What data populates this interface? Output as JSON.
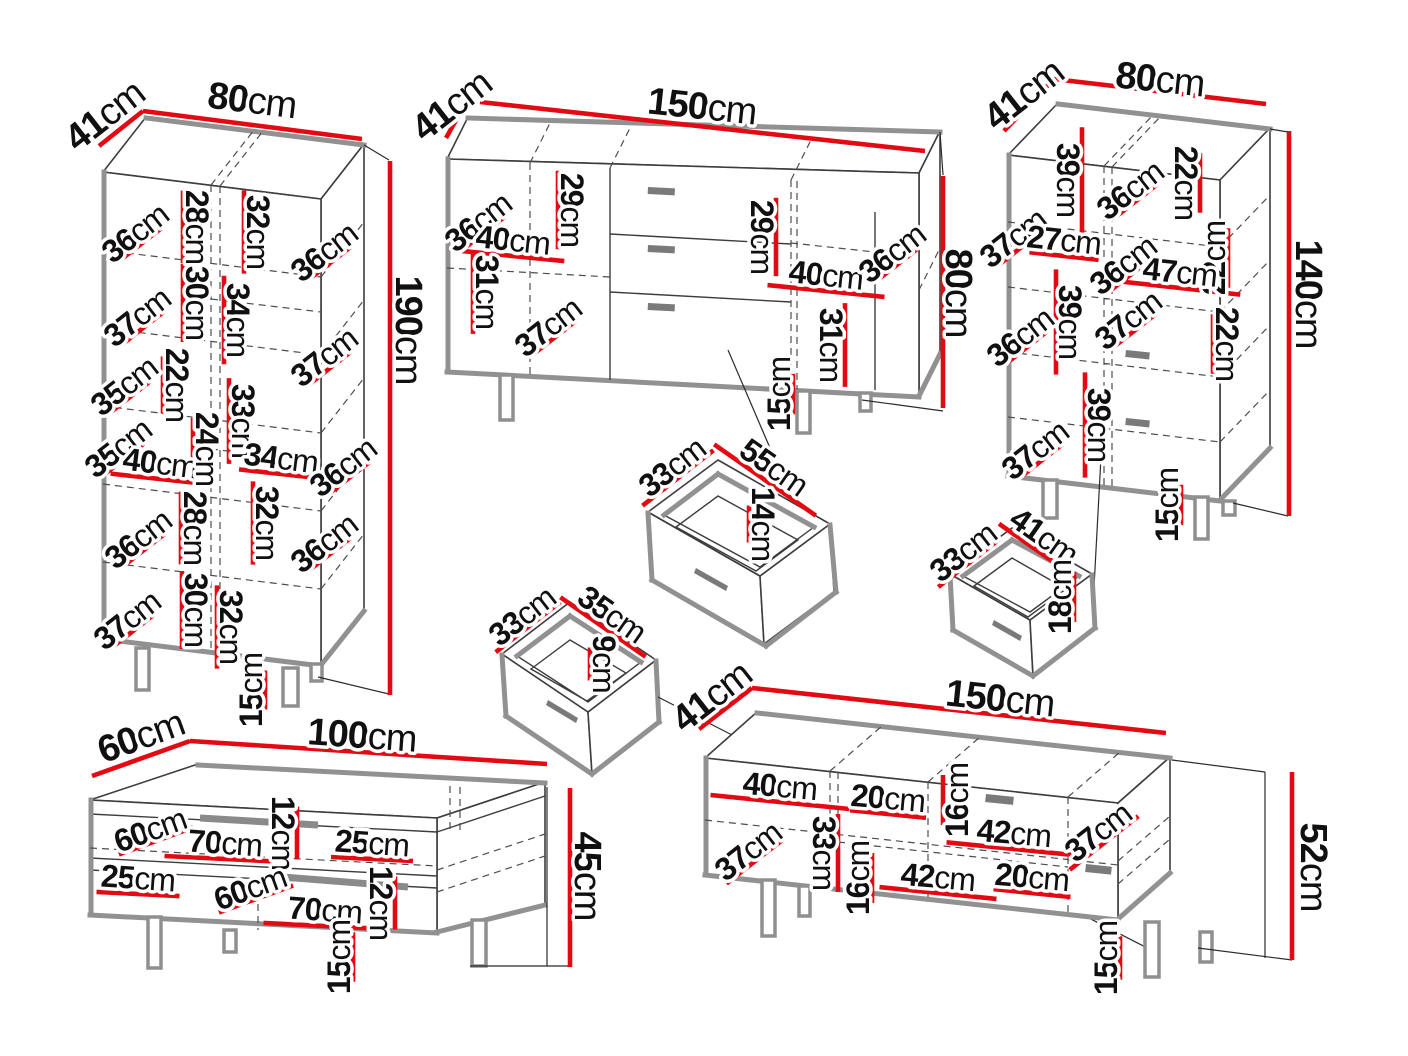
{
  "diagram_title": "furniture-dimensions-diagram",
  "unit": "cm",
  "colors": {
    "dimension_red": "#e30b13",
    "outline": "#3d3d3d",
    "shadow_gray": "#919191",
    "text": "#101010"
  },
  "pieces": [
    {
      "id": "tall-cabinet",
      "kind": "cabinet",
      "overall": {
        "width": "80cm",
        "depth": "41cm",
        "height": "190cm",
        "leg_height": "15cm"
      },
      "scale": 2.6,
      "dfac": 0.55,
      "hslope": 0.11,
      "labels": [
        {
          "t": "41cm",
          "x": 105,
          "y": 116,
          "r": -38,
          "s": "big",
          "line": "none"
        },
        {
          "t": "80cm",
          "x": 252,
          "y": 101,
          "r": 7,
          "s": "big",
          "line": "none"
        },
        {
          "t": "190cm",
          "x": 408,
          "y": 330,
          "r": 90,
          "s": "big",
          "line": "none"
        },
        {
          "t": "36cm",
          "x": 135,
          "y": 233,
          "r": -38
        },
        {
          "t": "28cm",
          "x": 197,
          "y": 227,
          "r": 90
        },
        {
          "t": "32cm",
          "x": 258,
          "y": 232,
          "r": 90
        },
        {
          "t": "36cm",
          "x": 324,
          "y": 252,
          "r": -38
        },
        {
          "t": "37cm",
          "x": 137,
          "y": 317,
          "r": -38
        },
        {
          "t": "30cm",
          "x": 197,
          "y": 303,
          "r": 90
        },
        {
          "t": "34cm",
          "x": 238,
          "y": 320,
          "r": 90
        },
        {
          "t": "37cm",
          "x": 324,
          "y": 357,
          "r": -38
        },
        {
          "t": "35cm",
          "x": 124,
          "y": 386,
          "r": -38
        },
        {
          "t": "22cm",
          "x": 177,
          "y": 385,
          "r": 90
        },
        {
          "t": "33cm",
          "x": 243,
          "y": 421,
          "r": 90
        },
        {
          "t": "35cm",
          "x": 118,
          "y": 448,
          "r": -38
        },
        {
          "t": "40cm",
          "x": 160,
          "y": 463,
          "r": 7
        },
        {
          "t": "24cm",
          "x": 207,
          "y": 449,
          "r": 90
        },
        {
          "t": "34cm",
          "x": 281,
          "y": 458,
          "r": 7
        },
        {
          "t": "36cm",
          "x": 343,
          "y": 467,
          "r": -38
        },
        {
          "t": "36cm",
          "x": 138,
          "y": 539,
          "r": -38
        },
        {
          "t": "28cm",
          "x": 195,
          "y": 528,
          "r": 90
        },
        {
          "t": "32cm",
          "x": 267,
          "y": 523,
          "r": 90
        },
        {
          "t": "36cm",
          "x": 324,
          "y": 543,
          "r": -38
        },
        {
          "t": "37cm",
          "x": 127,
          "y": 620,
          "r": -38
        },
        {
          "t": "30cm",
          "x": 196,
          "y": 610,
          "r": 90
        },
        {
          "t": "32cm",
          "x": 231,
          "y": 627,
          "r": 90
        },
        {
          "t": "15cm",
          "x": 251,
          "y": 690,
          "r": -90
        }
      ]
    },
    {
      "id": "sideboard",
      "kind": "sideboard",
      "overall": {
        "width": "150cm",
        "depth": "41cm",
        "height": "80cm",
        "leg_height": "15cm"
      },
      "scale": 2.7,
      "dfac": 0.55,
      "hslope": 0.1,
      "labels": [
        {
          "t": "41cm",
          "x": 452,
          "y": 106,
          "r": -38,
          "s": "big",
          "line": "none"
        },
        {
          "t": "150cm",
          "x": 702,
          "y": 107,
          "r": 6,
          "s": "big",
          "line": "none"
        },
        {
          "t": "80cm",
          "x": 958,
          "y": 293,
          "r": 90,
          "s": "big",
          "line": "none"
        },
        {
          "t": "36cm",
          "x": 478,
          "y": 222,
          "r": -38
        },
        {
          "t": "29cm",
          "x": 572,
          "y": 210,
          "r": 90
        },
        {
          "t": "40cm",
          "x": 513,
          "y": 240,
          "r": 6
        },
        {
          "t": "31cm",
          "x": 487,
          "y": 292,
          "r": 90
        },
        {
          "t": "37cm",
          "x": 548,
          "y": 327,
          "r": -38
        },
        {
          "t": "29cm",
          "x": 762,
          "y": 237,
          "r": 90,
          "side": 1
        },
        {
          "t": "40cm",
          "x": 826,
          "y": 275,
          "r": 6,
          "len": 117
        },
        {
          "t": "36cm",
          "x": 892,
          "y": 253,
          "r": -38
        },
        {
          "t": "31cm",
          "x": 831,
          "y": 345,
          "r": 90,
          "side": 1
        },
        {
          "t": "15cm",
          "x": 779,
          "y": 394,
          "r": -90
        }
      ]
    },
    {
      "id": "high-cabinet",
      "kind": "cabinet",
      "overall": {
        "width": "80cm",
        "depth": "41cm",
        "height": "140cm",
        "leg_height": "15cm"
      },
      "scale": 2.7,
      "dfac": 0.55,
      "hslope": 0.11,
      "labels": [
        {
          "t": "41cm",
          "x": 1024,
          "y": 95,
          "r": -38,
          "s": "big",
          "line": "none"
        },
        {
          "t": "80cm",
          "x": 1160,
          "y": 80,
          "r": 6,
          "s": "big",
          "line": "none"
        },
        {
          "t": "140cm",
          "x": 1308,
          "y": 294,
          "r": 90,
          "s": "big",
          "line": "none"
        },
        {
          "t": "39cm",
          "x": 1068,
          "y": 180,
          "r": 90,
          "side": 1
        },
        {
          "t": "36cm",
          "x": 1130,
          "y": 190,
          "r": -38
        },
        {
          "t": "22cm",
          "x": 1186,
          "y": 183,
          "r": 90,
          "side": 1
        },
        {
          "t": "37cm",
          "x": 1013,
          "y": 238,
          "r": -38
        },
        {
          "t": "27cm",
          "x": 1064,
          "y": 240,
          "r": 6
        },
        {
          "t": "22cm",
          "x": 1214,
          "y": 258,
          "r": -90
        },
        {
          "t": "36cm",
          "x": 1123,
          "y": 265,
          "r": -38
        },
        {
          "t": "47cm",
          "x": 1180,
          "y": 272,
          "r": 6
        },
        {
          "t": "36cm",
          "x": 1020,
          "y": 337,
          "r": -38
        },
        {
          "t": "39cm",
          "x": 1070,
          "y": 322,
          "r": 90
        },
        {
          "t": "37cm",
          "x": 1128,
          "y": 320,
          "r": -38
        },
        {
          "t": "22cm",
          "x": 1227,
          "y": 344,
          "r": 90
        },
        {
          "t": "39cm",
          "x": 1099,
          "y": 425,
          "r": 90
        },
        {
          "t": "37cm",
          "x": 1035,
          "y": 450,
          "r": -38
        },
        {
          "t": "15cm",
          "x": 1167,
          "y": 505,
          "r": -90
        }
      ]
    },
    {
      "id": "drawer-large",
      "kind": "drawer-box",
      "overall": {
        "width": "55cm",
        "depth": "33cm",
        "height": "14cm"
      },
      "scale": 2.5,
      "dfac": 0.55,
      "hslope": 0.11,
      "labels": [
        {
          "t": "33cm",
          "x": 672,
          "y": 467,
          "r": -38,
          "len": 90
        },
        {
          "t": "55cm",
          "x": 774,
          "y": 467,
          "r": 35,
          "len": 124
        },
        {
          "t": "14cm",
          "x": 763,
          "y": 524,
          "r": 90,
          "len": 37
        }
      ]
    },
    {
      "id": "drawer-medium",
      "kind": "drawer-box",
      "overall": {
        "width": "41cm",
        "depth": "33cm",
        "height": "18cm"
      },
      "scale": 2.5,
      "dfac": 0.55,
      "hslope": 0.11,
      "labels": [
        {
          "t": "33cm",
          "x": 963,
          "y": 552,
          "r": -38,
          "len": 78
        },
        {
          "t": "41cm",
          "x": 1044,
          "y": 536,
          "r": 35,
          "len": 88
        },
        {
          "t": "18cm",
          "x": 1060,
          "y": 597,
          "r": -90,
          "len": 50
        }
      ]
    },
    {
      "id": "drawer-small",
      "kind": "drawer-box",
      "overall": {
        "width": "35cm",
        "depth": "33cm",
        "height": "9cm"
      },
      "scale": 2.5,
      "dfac": 0.55,
      "hslope": 0.11,
      "labels": [
        {
          "t": "33cm",
          "x": 522,
          "y": 616,
          "r": -38,
          "len": 82
        },
        {
          "t": "35cm",
          "x": 612,
          "y": 614,
          "r": 35,
          "len": 104
        },
        {
          "t": "9cm",
          "x": 604,
          "y": 664,
          "r": 90,
          "len": 33
        }
      ]
    },
    {
      "id": "coffee-table",
      "kind": "coffee-table",
      "overall": {
        "width": "100cm",
        "depth": "60cm",
        "height": "45cm",
        "leg_height": "15cm"
      },
      "scale": 3.3,
      "dfac": 0.4,
      "hslope": 0.05,
      "labels": [
        {
          "t": "60cm",
          "x": 141,
          "y": 737,
          "r": -20,
          "s": "big",
          "line": "none"
        },
        {
          "t": "100cm",
          "x": 362,
          "y": 736,
          "r": 4,
          "s": "big",
          "line": "none"
        },
        {
          "t": "45cm",
          "x": 587,
          "y": 876,
          "r": 90,
          "s": "big",
          "line": "none"
        },
        {
          "t": "60cm",
          "x": 150,
          "y": 830,
          "r": -20,
          "len": 79
        },
        {
          "t": "70cm",
          "x": 225,
          "y": 843,
          "r": 4,
          "len": 121
        },
        {
          "t": "12cm",
          "x": 283,
          "y": 833,
          "r": 90,
          "side": 1,
          "len": 53
        },
        {
          "t": "25cm",
          "x": 372,
          "y": 843,
          "r": 4,
          "len": 82
        },
        {
          "t": "25cm",
          "x": 138,
          "y": 878,
          "r": 4,
          "len": 83
        },
        {
          "t": "60cm",
          "x": 250,
          "y": 888,
          "r": -20,
          "len": 79
        },
        {
          "t": "70cm",
          "x": 325,
          "y": 910,
          "r": 4,
          "len": 123
        },
        {
          "t": "12cm",
          "x": 381,
          "y": 903,
          "r": 90,
          "side": 1,
          "len": 53
        },
        {
          "t": "15cm",
          "x": 339,
          "y": 957,
          "r": -90
        }
      ]
    },
    {
      "id": "tv-stand",
      "kind": "tv-stand",
      "overall": {
        "width": "150cm",
        "depth": "41cm",
        "height": "52cm",
        "leg_height": "15cm"
      },
      "scale": 2.9,
      "dfac": 0.6,
      "hslope": 0.1,
      "labels": [
        {
          "t": "41cm",
          "x": 712,
          "y": 697,
          "r": -38,
          "s": "big",
          "line": "none"
        },
        {
          "t": "150cm",
          "x": 1000,
          "y": 699,
          "r": 6,
          "s": "big",
          "line": "none"
        },
        {
          "t": "52cm",
          "x": 1313,
          "y": 867,
          "r": 90,
          "s": "big",
          "line": "none"
        },
        {
          "t": "40cm",
          "x": 780,
          "y": 786,
          "r": 5,
          "len": 139
        },
        {
          "t": "20cm",
          "x": 888,
          "y": 798,
          "r": 5,
          "len": 76
        },
        {
          "t": "16cm",
          "x": 957,
          "y": 800,
          "r": -90,
          "side": -1,
          "len": 50
        },
        {
          "t": "42cm",
          "x": 1014,
          "y": 833,
          "r": 5,
          "len": 135
        },
        {
          "t": "37cm",
          "x": 1098,
          "y": 832,
          "r": -38,
          "len": 87
        },
        {
          "t": "37cm",
          "x": 748,
          "y": 851,
          "r": -38,
          "len": 70
        },
        {
          "t": "33cm",
          "x": 824,
          "y": 853,
          "r": 90,
          "side": 1,
          "len": 78
        },
        {
          "t": "16cm",
          "x": 858,
          "y": 878,
          "r": -90,
          "len": 50
        },
        {
          "t": "42cm",
          "x": 938,
          "y": 877,
          "r": 5,
          "len": 117
        },
        {
          "t": "20cm",
          "x": 1032,
          "y": 877,
          "r": 5,
          "len": 77
        },
        {
          "t": "15cm",
          "x": 1106,
          "y": 958,
          "r": -90
        }
      ]
    }
  ]
}
